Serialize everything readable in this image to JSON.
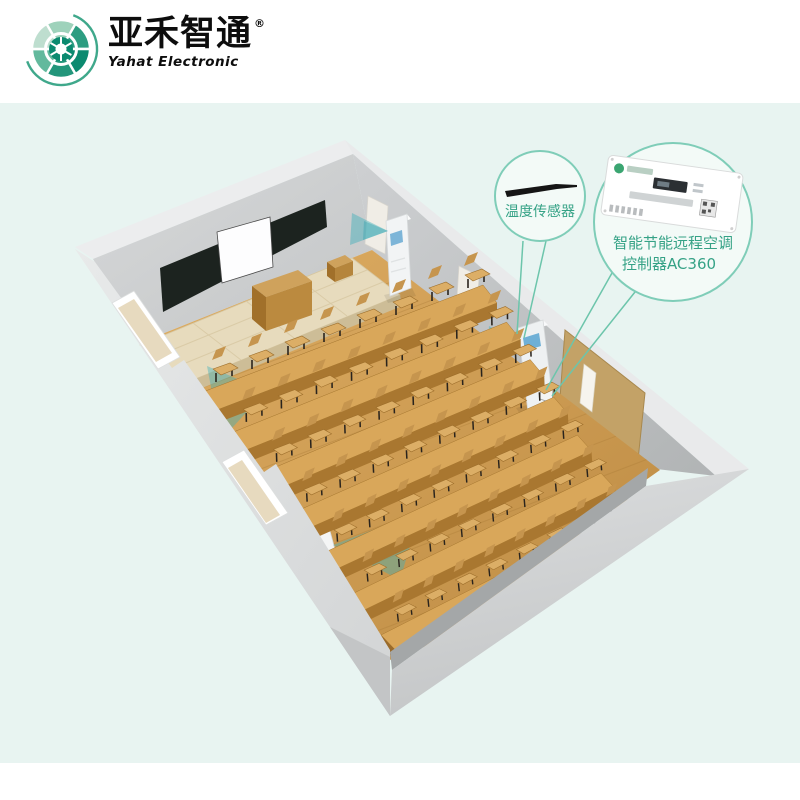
{
  "brand": {
    "name_cn": "亚禾智通",
    "trademark_symbol": "®",
    "name_en": "Yahat Electronic"
  },
  "callouts": {
    "temperature_sensor": {
      "label": "温度传感器"
    },
    "ac_controller": {
      "label_line1": "智能节能远程空调",
      "label_line2": "控制器AC360"
    }
  },
  "colors": {
    "accent_teal": "#35a286",
    "callout_stroke": "#7fcdb8",
    "leader_line": "#6cc5ab",
    "background_mint": "#e8f4f1",
    "blackboard": "#1c231f",
    "airflow_teal": "#3fb0ba",
    "wood_floor": "#d2a055",
    "wall_gray": "#c9cbcc"
  }
}
